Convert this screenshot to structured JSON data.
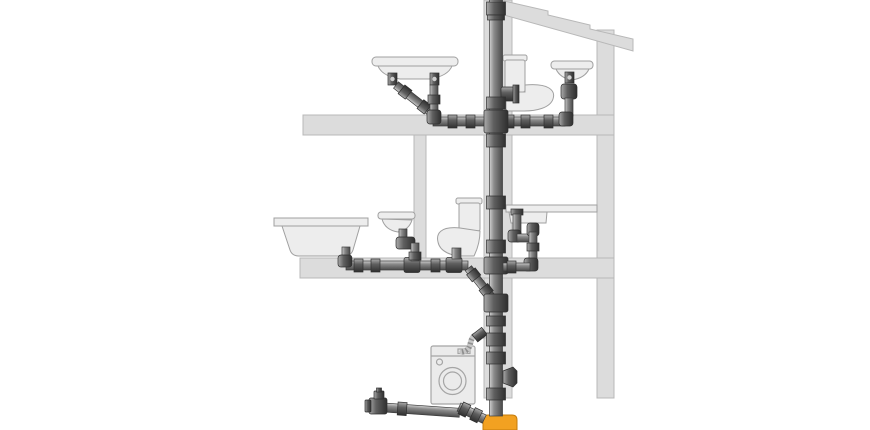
{
  "diagram": {
    "kind": "building-drainage-system-cross-section",
    "floors": [
      {
        "id": "top-floor",
        "fixtures": [
          "washbasin-with-double-trap",
          "toilet",
          "washbasin-with-bottle-trap"
        ]
      },
      {
        "id": "middle-floor",
        "fixtures": [
          "bathtub",
          "wall-hung-washbasin",
          "toilet",
          "kitchen-sink-with-loop-trap"
        ]
      },
      {
        "id": "ground-floor",
        "fixtures": [
          "washing-machine-with-drain-hose",
          "capped-cleanout-pipe"
        ]
      }
    ],
    "pipe_system": {
      "main": "vertical-soil-stack",
      "outlet": "orange-underground-adapter",
      "branches": [
        "top-floor-branch",
        "middle-floor-branch",
        "kitchen-branch",
        "washing-machine-hose",
        "ground-floor-branch"
      ]
    }
  },
  "colors": {
    "bg": "#ffffff",
    "wall": "#dcdcdc",
    "wall_border": "#b8b8b8",
    "fixture": "#ededed",
    "fixture_border": "#a0a0a0",
    "fixture_detail": "#d6d6d6",
    "pipe_light": "#d0d0d0",
    "pipe_mid": "#8a8a8a",
    "pipe_dark": "#4a4a4a",
    "fit_light": "#ababab",
    "fit_mid": "#5f5f5f",
    "fit_dark": "#2f2f2f",
    "outline": "#3c3c3c",
    "hose": "#c6c6c6",
    "hose_shade": "#8f8f8f",
    "orange": "#f2a121",
    "orange_border": "#c47c0c",
    "machine": "#ebebeb",
    "machine_border": "#a5a5a5"
  }
}
